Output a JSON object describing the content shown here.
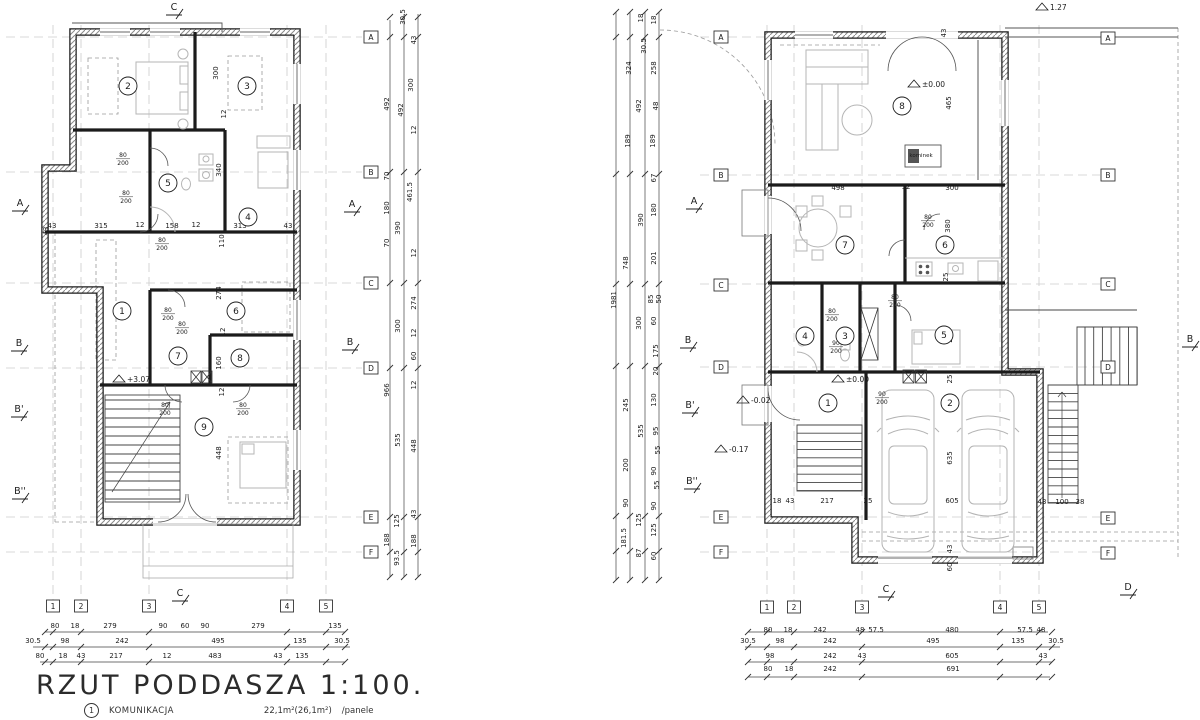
{
  "title_block": {
    "title": "RZUT PODDASZA 1:100.",
    "legend_num": "1",
    "legend_label": "KOMUNIKACJA",
    "legend_area": "22,1m²(26,1m²)",
    "legend_finish": "/panele"
  },
  "left_plan": {
    "name": "attic-plan",
    "rooms": [
      [
        "1",
        122,
        311
      ],
      [
        "2",
        128,
        86
      ],
      [
        "3",
        247,
        86
      ],
      [
        "4",
        248,
        217
      ],
      [
        "5",
        168,
        183
      ],
      [
        "6",
        236,
        311
      ],
      [
        "7",
        178,
        356
      ],
      [
        "8",
        240,
        358
      ],
      [
        "9",
        204,
        427
      ]
    ],
    "grid_labels": [
      [
        "A",
        371,
        37
      ],
      [
        "B",
        371,
        172
      ],
      [
        "C",
        371,
        283
      ],
      [
        "D",
        371,
        368
      ],
      [
        "E",
        371,
        517
      ],
      [
        "F",
        371,
        552
      ]
    ],
    "axis_bubbles": [
      [
        "1",
        53,
        606
      ],
      [
        "2",
        81,
        606
      ],
      [
        "3",
        149,
        606
      ],
      [
        "4",
        287,
        606
      ],
      [
        "5",
        326,
        606
      ]
    ],
    "section_markers": [
      [
        "A",
        20,
        206
      ],
      [
        "B",
        19,
        346
      ],
      [
        "B'",
        19,
        412
      ],
      [
        "B''",
        20,
        494
      ],
      [
        "A",
        352,
        207
      ],
      [
        "B",
        350,
        345
      ],
      [
        "C",
        180,
        596
      ],
      [
        "C",
        174,
        10
      ]
    ],
    "dims": [
      [
        "30.5",
        405,
        17,
        1
      ],
      [
        "43",
        416,
        40,
        1
      ],
      [
        "492",
        389,
        104,
        1
      ],
      [
        "300",
        413,
        85,
        1
      ],
      [
        "492",
        403,
        110,
        1
      ],
      [
        "12",
        416,
        130,
        1
      ],
      [
        "70",
        389,
        176,
        1
      ],
      [
        "461.5",
        412,
        192,
        1
      ],
      [
        "180",
        389,
        208,
        1
      ],
      [
        "390",
        400,
        228,
        1
      ],
      [
        "70",
        389,
        243,
        1
      ],
      [
        "12",
        416,
        253,
        1
      ],
      [
        "274",
        416,
        303,
        1
      ],
      [
        "300",
        400,
        326,
        1
      ],
      [
        "12",
        416,
        333,
        1
      ],
      [
        "60",
        416,
        356,
        1
      ],
      [
        "966",
        389,
        390,
        1
      ],
      [
        "12",
        416,
        385,
        1
      ],
      [
        "535",
        400,
        440,
        1
      ],
      [
        "448",
        416,
        446,
        1
      ],
      [
        "43",
        416,
        514,
        1
      ],
      [
        "125",
        399,
        521,
        1
      ],
      [
        "188",
        389,
        540,
        1
      ],
      [
        "188",
        416,
        541,
        1
      ],
      [
        "93.5",
        399,
        558,
        1
      ],
      [
        "300",
        218,
        73,
        1
      ],
      [
        "12",
        226,
        114,
        1
      ],
      [
        "340",
        221,
        170,
        1
      ],
      [
        "43",
        52,
        228
      ],
      [
        "315",
        101,
        228
      ],
      [
        "12",
        140,
        227
      ],
      [
        "158",
        172,
        228
      ],
      [
        "12",
        196,
        227
      ],
      [
        "313",
        240,
        228
      ],
      [
        "43",
        288,
        228
      ],
      [
        "110",
        224,
        241,
        1
      ],
      [
        "274",
        221,
        293,
        1
      ],
      [
        "12",
        225,
        332,
        1
      ],
      [
        "160",
        221,
        363,
        1
      ],
      [
        "12",
        224,
        392,
        1
      ],
      [
        "448",
        221,
        453,
        1
      ],
      [
        "43",
        48,
        231,
        1
      ],
      [
        "80",
        55,
        628
      ],
      [
        "18",
        75,
        628
      ],
      [
        "279",
        110,
        628
      ],
      [
        "90",
        163,
        628
      ],
      [
        "60",
        185,
        628
      ],
      [
        "90",
        205,
        628
      ],
      [
        "279",
        258,
        628
      ],
      [
        "135",
        335,
        628
      ],
      [
        "30.5",
        33,
        643
      ],
      [
        "98",
        65,
        643
      ],
      [
        "242",
        122,
        643
      ],
      [
        "495",
        218,
        643
      ],
      [
        "135",
        300,
        643
      ],
      [
        "30.5",
        342,
        643
      ],
      [
        "80",
        40,
        658
      ],
      [
        "18",
        63,
        658
      ],
      [
        "43",
        81,
        658
      ],
      [
        "217",
        116,
        658
      ],
      [
        "12",
        167,
        658
      ],
      [
        "483",
        215,
        658
      ],
      [
        "43",
        278,
        658
      ],
      [
        "135",
        302,
        658
      ]
    ],
    "door_labels": [
      [
        "80/200",
        123,
        158
      ],
      [
        "80/200",
        126,
        196
      ],
      [
        "80/200",
        162,
        243
      ],
      [
        "80/200",
        168,
        313
      ],
      [
        "80/200",
        182,
        327
      ],
      [
        "80/200",
        165,
        408
      ],
      [
        "80/200",
        243,
        408
      ]
    ],
    "elevations": [
      [
        "+3.07",
        126,
        379
      ]
    ],
    "labels": []
  },
  "right_plan": {
    "name": "ground-plan",
    "rooms": [
      [
        "1",
        828,
        403
      ],
      [
        "2",
        950,
        403
      ],
      [
        "3",
        845,
        336
      ],
      [
        "4",
        805,
        336
      ],
      [
        "5",
        944,
        335
      ],
      [
        "6",
        945,
        245
      ],
      [
        "7",
        845,
        245
      ],
      [
        "8",
        902,
        106
      ]
    ],
    "grid_labels": [
      [
        "A",
        721,
        37
      ],
      [
        "B",
        721,
        175
      ],
      [
        "C",
        721,
        285
      ],
      [
        "D",
        721,
        367
      ],
      [
        "E",
        721,
        517
      ],
      [
        "F",
        721,
        552
      ],
      [
        "A",
        1108,
        38
      ],
      [
        "B",
        1108,
        175
      ],
      [
        "C",
        1108,
        284
      ],
      [
        "D",
        1108,
        367
      ],
      [
        "E",
        1108,
        518
      ],
      [
        "F",
        1108,
        553
      ]
    ],
    "axis_bubbles": [
      [
        "1",
        767,
        607
      ],
      [
        "2",
        794,
        607
      ],
      [
        "3",
        862,
        607
      ],
      [
        "4",
        1000,
        607
      ],
      [
        "5",
        1039,
        607
      ]
    ],
    "section_markers": [
      [
        "A",
        694,
        204
      ],
      [
        "B",
        688,
        343
      ],
      [
        "B'",
        690,
        408
      ],
      [
        "B''",
        692,
        484
      ],
      [
        "B",
        1190,
        342
      ],
      [
        "C",
        886,
        592
      ],
      [
        "D",
        1128,
        590
      ]
    ],
    "dims": [
      [
        "1981",
        616,
        300,
        1
      ],
      [
        "324",
        631,
        68,
        1
      ],
      [
        "18",
        643,
        18,
        1
      ],
      [
        "18",
        656,
        20,
        1
      ],
      [
        "30.5",
        646,
        46,
        1
      ],
      [
        "258",
        656,
        68,
        1
      ],
      [
        "492",
        641,
        106,
        1
      ],
      [
        "48",
        658,
        106,
        1
      ],
      [
        "189",
        630,
        141,
        1
      ],
      [
        "189",
        655,
        141,
        1
      ],
      [
        "67",
        656,
        178,
        1
      ],
      [
        "180",
        656,
        210,
        1
      ],
      [
        "390",
        643,
        220,
        1
      ],
      [
        "201",
        656,
        258,
        1
      ],
      [
        "748",
        628,
        263,
        1
      ],
      [
        "85",
        653,
        299,
        1
      ],
      [
        "50",
        661,
        299,
        1
      ],
      [
        "300",
        641,
        323,
        1
      ],
      [
        "60",
        656,
        321,
        1
      ],
      [
        "175",
        658,
        351,
        1
      ],
      [
        "20",
        658,
        371,
        1
      ],
      [
        "245",
        628,
        405,
        1
      ],
      [
        "130",
        656,
        400,
        1
      ],
      [
        "535",
        643,
        431,
        1
      ],
      [
        "95",
        658,
        431,
        1
      ],
      [
        "55",
        660,
        450,
        1
      ],
      [
        "200",
        628,
        465,
        1
      ],
      [
        "90",
        656,
        471,
        1
      ],
      [
        "55",
        659,
        485,
        1
      ],
      [
        "90",
        628,
        503,
        1
      ],
      [
        "90",
        656,
        506,
        1
      ],
      [
        "125",
        641,
        520,
        1
      ],
      [
        "125",
        656,
        530,
        1
      ],
      [
        "181.5",
        626,
        538,
        1
      ],
      [
        "87",
        641,
        553,
        1
      ],
      [
        "60",
        656,
        556,
        1
      ],
      [
        "43",
        946,
        33,
        1
      ],
      [
        "498",
        838,
        190
      ],
      [
        "12",
        906,
        189
      ],
      [
        "300",
        952,
        190
      ],
      [
        "465",
        951,
        103,
        1
      ],
      [
        "380",
        950,
        226,
        1
      ],
      [
        "25",
        948,
        277,
        1
      ],
      [
        "275",
        952,
        336,
        1
      ],
      [
        "25",
        952,
        379,
        1
      ],
      [
        "635",
        952,
        458,
        1
      ],
      [
        "18",
        777,
        503
      ],
      [
        "43",
        790,
        503
      ],
      [
        "217",
        827,
        503
      ],
      [
        "25",
        868,
        503
      ],
      [
        "605",
        952,
        503
      ],
      [
        "43",
        1042,
        504
      ],
      [
        "100",
        1062,
        504
      ],
      [
        "38",
        1080,
        504
      ],
      [
        "43",
        952,
        549,
        1
      ],
      [
        "60",
        952,
        567,
        1
      ],
      [
        "80",
        768,
        632
      ],
      [
        "18",
        788,
        632
      ],
      [
        "242",
        820,
        632
      ],
      [
        "48",
        860,
        632
      ],
      [
        "57.5",
        876,
        632
      ],
      [
        "480",
        952,
        632
      ],
      [
        "57.5",
        1025,
        632
      ],
      [
        "48",
        1041,
        632
      ],
      [
        "30.5",
        748,
        643
      ],
      [
        "98",
        780,
        643
      ],
      [
        "242",
        830,
        643
      ],
      [
        "495",
        933,
        643
      ],
      [
        "135",
        1018,
        643
      ],
      [
        "30.5",
        1056,
        643
      ],
      [
        "98",
        770,
        658
      ],
      [
        "242",
        830,
        658
      ],
      [
        "43",
        862,
        658
      ],
      [
        "605",
        952,
        658
      ],
      [
        "43",
        1043,
        658
      ],
      [
        "80",
        768,
        671
      ],
      [
        "18",
        789,
        671
      ],
      [
        "242",
        830,
        671
      ],
      [
        "691",
        953,
        671
      ]
    ],
    "door_labels": [
      [
        "80/200",
        928,
        220
      ],
      [
        "80/200",
        895,
        300
      ],
      [
        "80/200",
        832,
        314
      ],
      [
        "90/200",
        836,
        346
      ],
      [
        "90/200",
        882,
        397
      ]
    ],
    "elevations": [
      [
        "±0.00",
        921,
        84
      ],
      [
        "±0.00",
        845,
        379
      ],
      [
        "-0.02",
        750,
        400
      ],
      [
        "-0.17",
        728,
        449
      ],
      [
        "1.27",
        1049,
        7
      ]
    ],
    "labels": [
      [
        "kominek",
        921,
        157
      ]
    ]
  }
}
